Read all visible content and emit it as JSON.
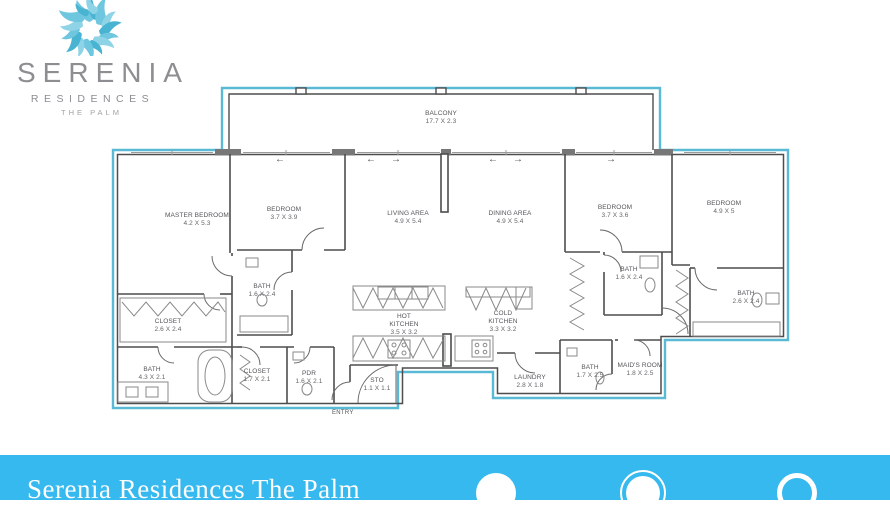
{
  "colors": {
    "footer_bar": "#36b9ee",
    "plan_outline": "#5ab9d5",
    "wall": "#4d4d4d",
    "logo_blue": "#66c3de",
    "logo_text": "#8d8d92"
  },
  "logo": {
    "brand": "SERENIA",
    "line2": "RESIDENCES",
    "line3": "THE PALM"
  },
  "plan": {
    "entry_label": "ENTRY",
    "arrows": [
      "←",
      "←",
      "→",
      "←",
      "→",
      "→"
    ],
    "rooms": [
      {
        "id": "balcony",
        "name": "BALCONY",
        "dims": "17.7 X 2.3"
      },
      {
        "id": "master-bedroom",
        "name": "MASTER BEDROOM",
        "dims": "4.2 X 5.3"
      },
      {
        "id": "bedroom-2",
        "name": "BEDROOM",
        "dims": "3.7 X 3.9"
      },
      {
        "id": "living-area",
        "name": "LIVING AREA",
        "dims": "4.9 X 5.4"
      },
      {
        "id": "dining-area",
        "name": "DINING AREA",
        "dims": "4.9 X 5.4"
      },
      {
        "id": "bedroom-3",
        "name": "BEDROOM",
        "dims": "3.7 X 3.6"
      },
      {
        "id": "bedroom-4",
        "name": "BEDROOM",
        "dims": "4.9 X 5"
      },
      {
        "id": "bath-bedroom-2",
        "name": "BATH",
        "dims": "1.6 X 2.4"
      },
      {
        "id": "bath-bedroom-3",
        "name": "BATH",
        "dims": "1.6 X 2.4"
      },
      {
        "id": "bath-bedroom-4",
        "name": "BATH",
        "dims": "2.6 X 2.4"
      },
      {
        "id": "closet-master",
        "name": "CLOSET",
        "dims": "2.6 X 2.4"
      },
      {
        "id": "bath-master",
        "name": "BATH",
        "dims": "4.3 X 2.1"
      },
      {
        "id": "closet-2",
        "name": "CLOSET",
        "dims": "1.7 X 2.1"
      },
      {
        "id": "powder-room",
        "name": "PDR",
        "dims": "1.6 X 2.1"
      },
      {
        "id": "storage",
        "name": "STO",
        "dims": "1.1 X 1.1"
      },
      {
        "id": "hot-kitchen",
        "name": "HOT KITCHEN",
        "dims": "3.5 X 3.2"
      },
      {
        "id": "cold-kitchen",
        "name": "COLD KITCHEN",
        "dims": "3.3 X 3.2"
      },
      {
        "id": "laundry",
        "name": "LAUNDRY",
        "dims": "2.8 X 1.8"
      },
      {
        "id": "bath-maids",
        "name": "BATH",
        "dims": "1.7 X 2.5"
      },
      {
        "id": "maids-room",
        "name": "MAID'S ROOM",
        "dims": "1.8 X 2.5"
      }
    ]
  },
  "footer": {
    "title": "Serenia Residences The Palm"
  }
}
